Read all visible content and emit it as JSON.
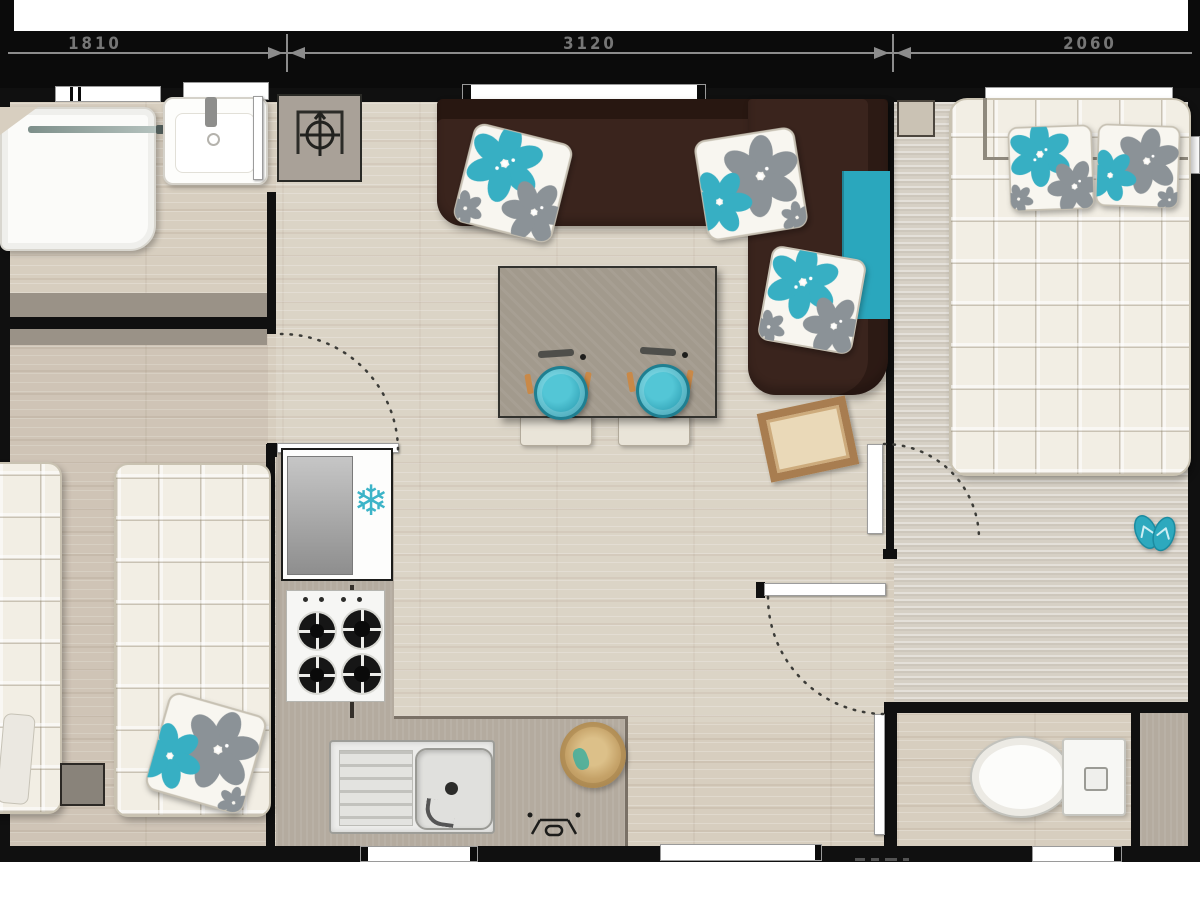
{
  "dimensions": {
    "left": "1810",
    "middle": "3120",
    "right": "2060"
  },
  "glyphs": {
    "snowflake": "❄"
  },
  "palette": {
    "accent_turquoise": "#37afc3",
    "sofa_brown": "#3a241d",
    "wall_black": "#0b0b0b",
    "floor_wood": "#d7cebf",
    "counter_gray": "#b4ab9f",
    "quilt_white": "#f2eee4",
    "basket_tan": "#a87d50"
  },
  "icons": [
    {
      "name": "snowflake-icon",
      "meaning": "refrigerator"
    },
    {
      "name": "crosshair-icon",
      "meaning": "boiler unit"
    }
  ]
}
